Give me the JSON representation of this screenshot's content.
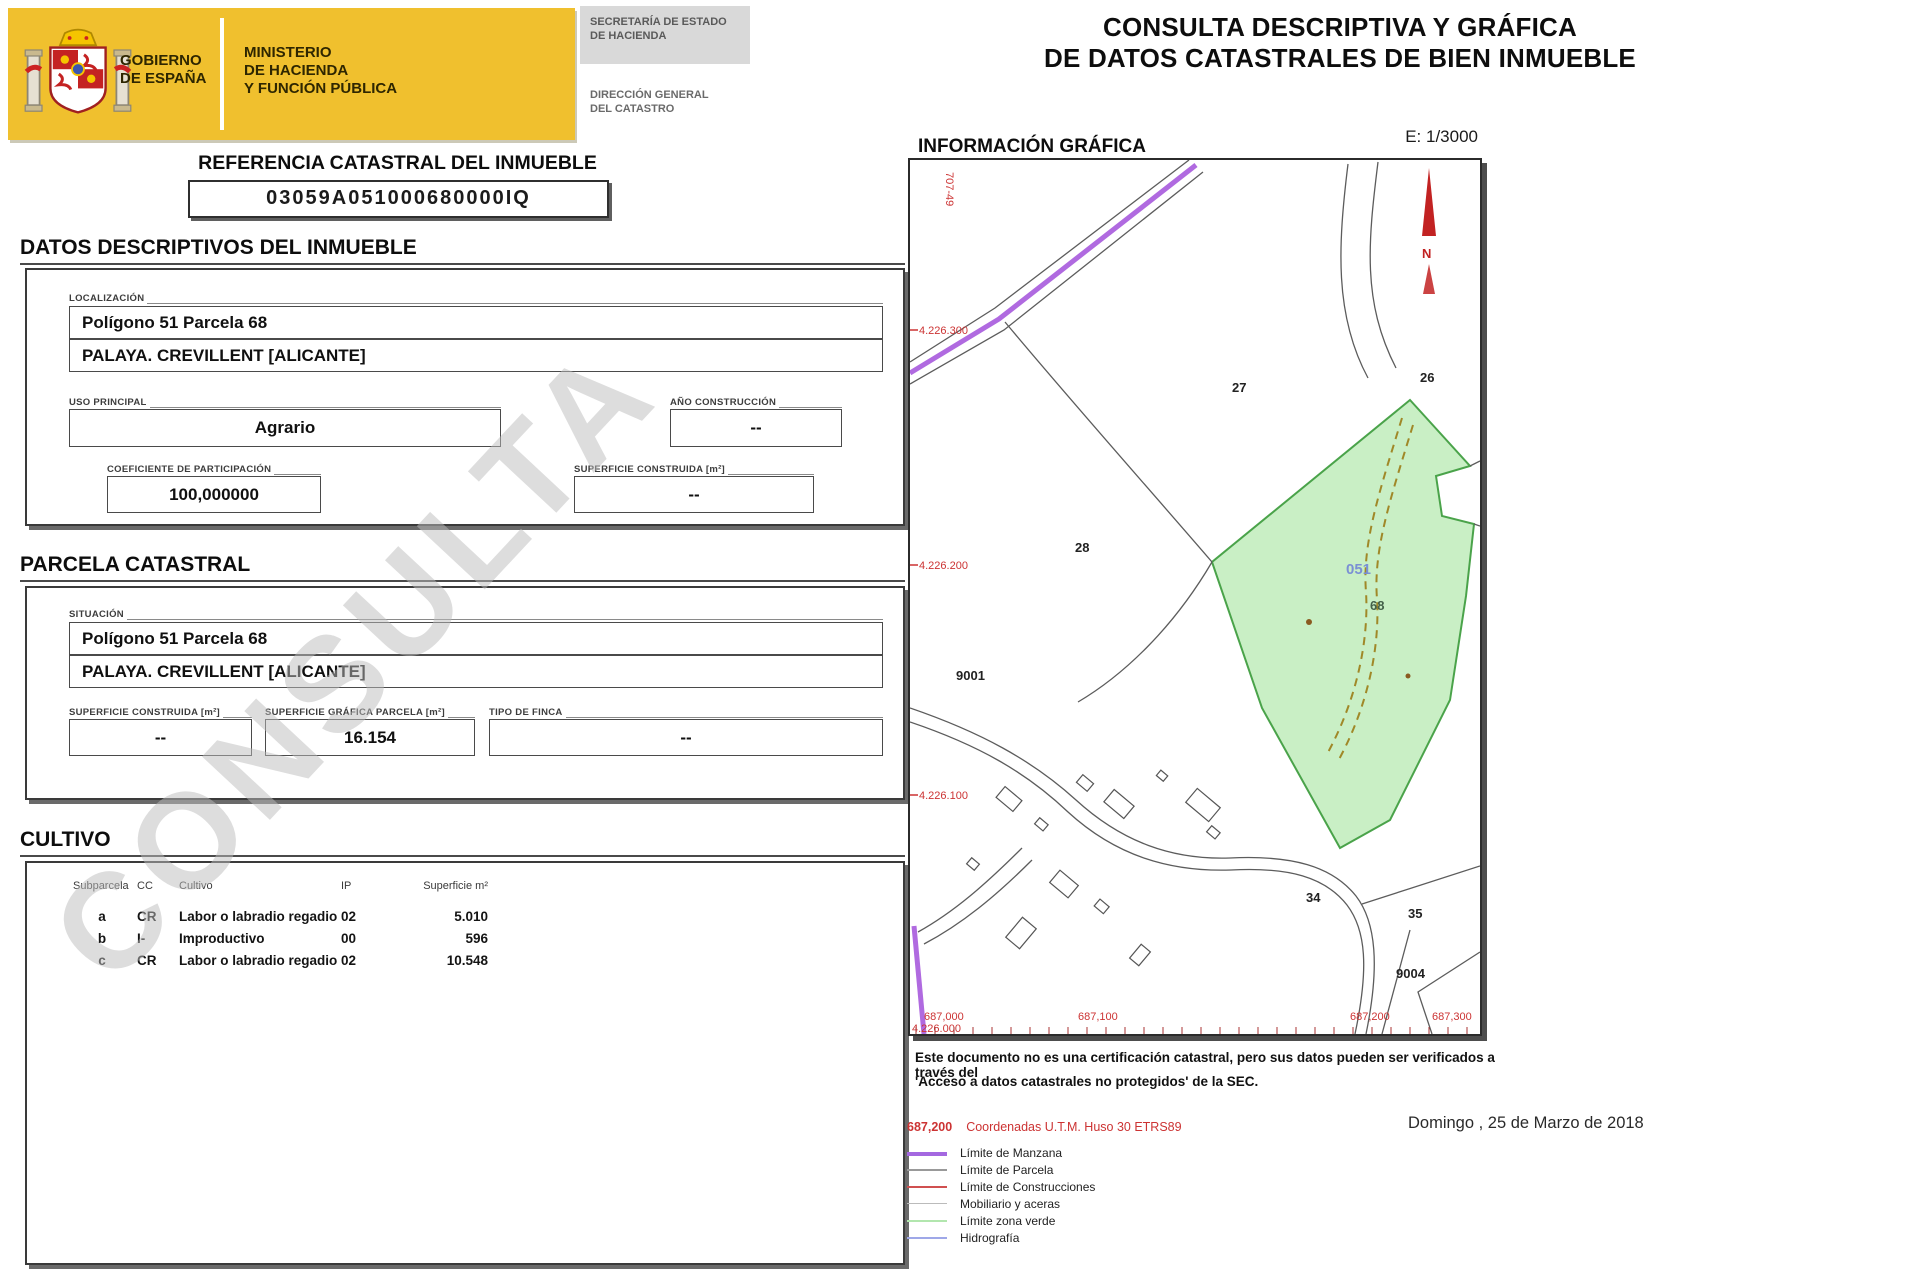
{
  "watermark": "CONSULTA",
  "header": {
    "gobierno_l1": "GOBIERNO",
    "gobierno_l2": "DE ESPAÑA",
    "ministerio_l1": "MINISTERIO",
    "ministerio_l2": "DE HACIENDA",
    "ministerio_l3": "Y FUNCIÓN PÚBLICA",
    "secretaria_l1": "SECRETARÍA DE ESTADO",
    "secretaria_l2": "DE HACIENDA",
    "direccion_l1": "DIRECCIÓN GENERAL",
    "direccion_l2": "DEL CATASTRO"
  },
  "title": {
    "line1": "CONSULTA DESCRIPTIVA Y GRÁFICA",
    "line2": "DE DATOS CATASTRALES DE BIEN INMUEBLE"
  },
  "referencia": {
    "heading": "REFERENCIA CATASTRAL DEL INMUEBLE",
    "value": "03059A051000680000IQ"
  },
  "datos": {
    "heading": "DATOS DESCRIPTIVOS DEL INMUEBLE",
    "localizacion_label": "LOCALIZACIÓN",
    "localizacion_line1": "Polígono 51 Parcela 68",
    "localizacion_line2": "PALAYA. CREVILLENT [ALICANTE]",
    "uso_label": "USO PRINCIPAL",
    "uso_value": "Agrario",
    "ano_label": "AÑO CONSTRUCCIÓN",
    "ano_value": "--",
    "coeficiente_label": "COEFICIENTE DE PARTICIPACIÓN",
    "coeficiente_value": "100,000000",
    "superficie_label": "SUPERFICIE CONSTRUIDA [m²]",
    "superficie_value": "--"
  },
  "parcela": {
    "heading": "PARCELA CATASTRAL",
    "situacion_label": "SITUACIÓN",
    "situacion_line1": "Polígono 51 Parcela 68",
    "situacion_line2": "PALAYA. CREVILLENT [ALICANTE]",
    "sup_construida_label": "SUPERFICIE CONSTRUIDA [m²]",
    "sup_construida_value": "--",
    "sup_grafica_label": "SUPERFICIE GRÁFICA PARCELA [m²]",
    "sup_grafica_value": "16.154",
    "tipo_finca_label": "TIPO DE FINCA",
    "tipo_finca_value": "--"
  },
  "cultivo": {
    "heading": "CULTIVO",
    "columns": [
      "Subparcela",
      "CC",
      "Cultivo",
      "IP",
      "Superficie m²"
    ],
    "rows": [
      [
        "a",
        "CR",
        "Labor o labradio regadio",
        "02",
        "5.010"
      ],
      [
        "b",
        "I-",
        "Improductivo",
        "00",
        "596"
      ],
      [
        "c",
        "CR",
        "Labor o labradio regadio",
        "02",
        "10.548"
      ]
    ]
  },
  "mapa": {
    "heading": "INFORMACIÓN GRÁFICA",
    "escala": "E: 1/3000",
    "norte": "N",
    "road_label": "707-49",
    "parcelas": {
      "p27": "27",
      "p26": "26",
      "p28": "28",
      "p051": "051",
      "p68": "68",
      "p9001": "9001",
      "p34": "34",
      "p35": "35",
      "p9004": "9004"
    },
    "coordenadas_norte": [
      "4.226.300",
      "4.226.200",
      "4.226.100",
      "4.226.000"
    ],
    "coordenadas_este": [
      "687,000",
      "687,100",
      "687,200",
      "687,300"
    ]
  },
  "disclaimer": {
    "line1": "Este documento no es una certificación catastral, pero sus datos pueden ser verificados a través del",
    "line2": "'Acceso a datos catastrales no protegidos' de la SEC."
  },
  "leyenda": {
    "coord_sample": "687,200",
    "coord_label": "Coordenadas U.T.M. Huso 30 ETRS89",
    "items": [
      {
        "label": "Límite de Manzana",
        "color": "#a468e0"
      },
      {
        "label": "Límite de Parcela",
        "color": "#999999"
      },
      {
        "label": "Límite de Construcciones",
        "color": "#d05050"
      },
      {
        "label": "Mobiliario y aceras",
        "color": "#bbbbbb"
      },
      {
        "label": "Límite zona verde",
        "color": "#b2e6ae"
      },
      {
        "label": "Hidrografía",
        "color": "#9fa8e8"
      }
    ]
  },
  "fecha": "Domingo , 25 de Marzo de 2018",
  "colors": {
    "banner_yellow": "#f0c02e",
    "map_green_fill": "#c9efc5",
    "map_green_stroke": "#4aa34a",
    "manzana_purple": "#b06ae0",
    "coord_red": "#cc3333"
  }
}
